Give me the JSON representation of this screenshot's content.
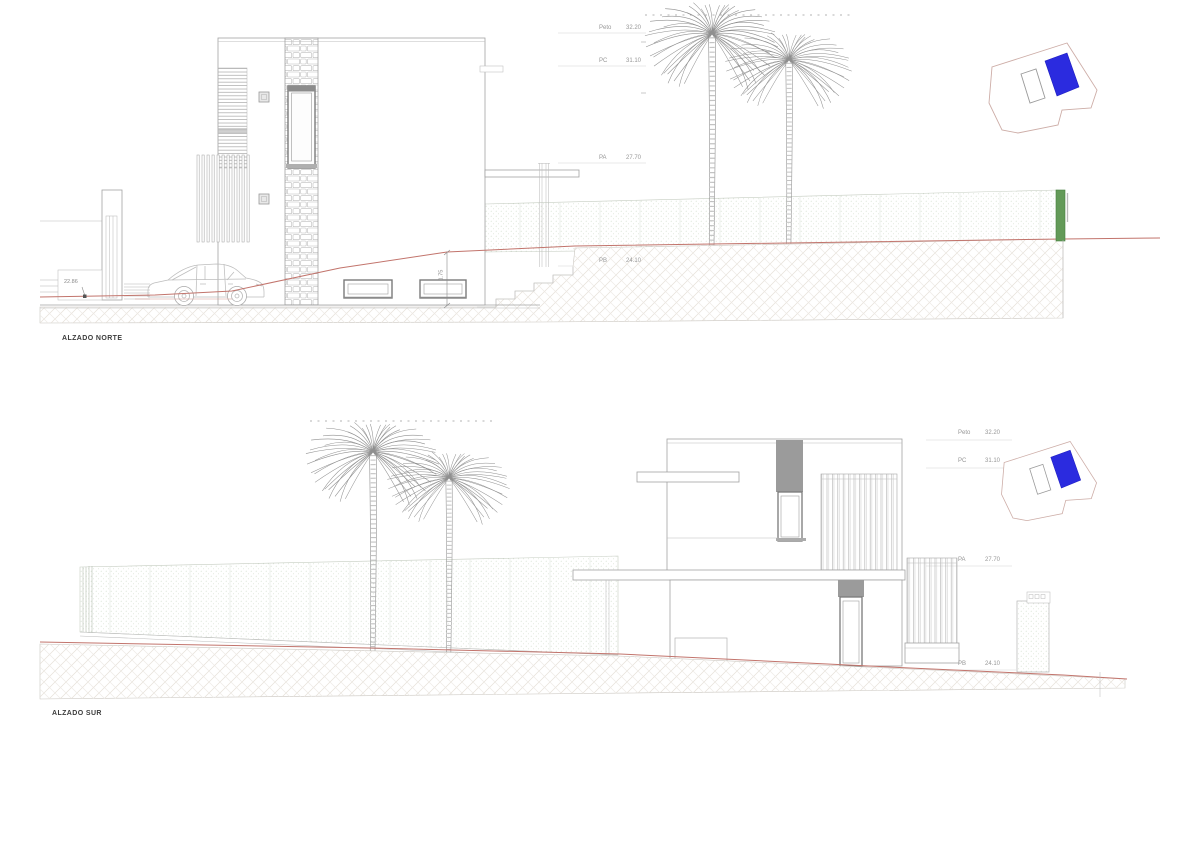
{
  "sheet": {
    "background_color": "#ffffff"
  },
  "elevations": {
    "north": {
      "title": "ALZADO NORTE",
      "levels": [
        {
          "label": "Peto",
          "value": "32.20"
        },
        {
          "label": "PC",
          "value": "31.10"
        },
        {
          "label": "PA",
          "value": "27.70"
        },
        {
          "label": "PB",
          "value": "24.10"
        }
      ],
      "dimensions": {
        "street_level": "22.86",
        "basement_exposure": "1.75"
      }
    },
    "south": {
      "title": "ALZADO SUR",
      "levels": [
        {
          "label": "Peto",
          "value": "32.20"
        },
        {
          "label": "PC",
          "value": "31.10"
        },
        {
          "label": "PA",
          "value": "27.70"
        },
        {
          "label": "PB",
          "value": "24.10"
        }
      ]
    }
  },
  "site_plan_key": {
    "house_footprint_color": "#2b2bdf",
    "pool_outline_color": "#9a9a9a",
    "plot_boundary_color": "#cdada7"
  },
  "drawing_colors": {
    "terrain_line_red": "#c2746c",
    "hedge_green_accent": "#639a58",
    "line_gray": "#9a9a9a"
  }
}
